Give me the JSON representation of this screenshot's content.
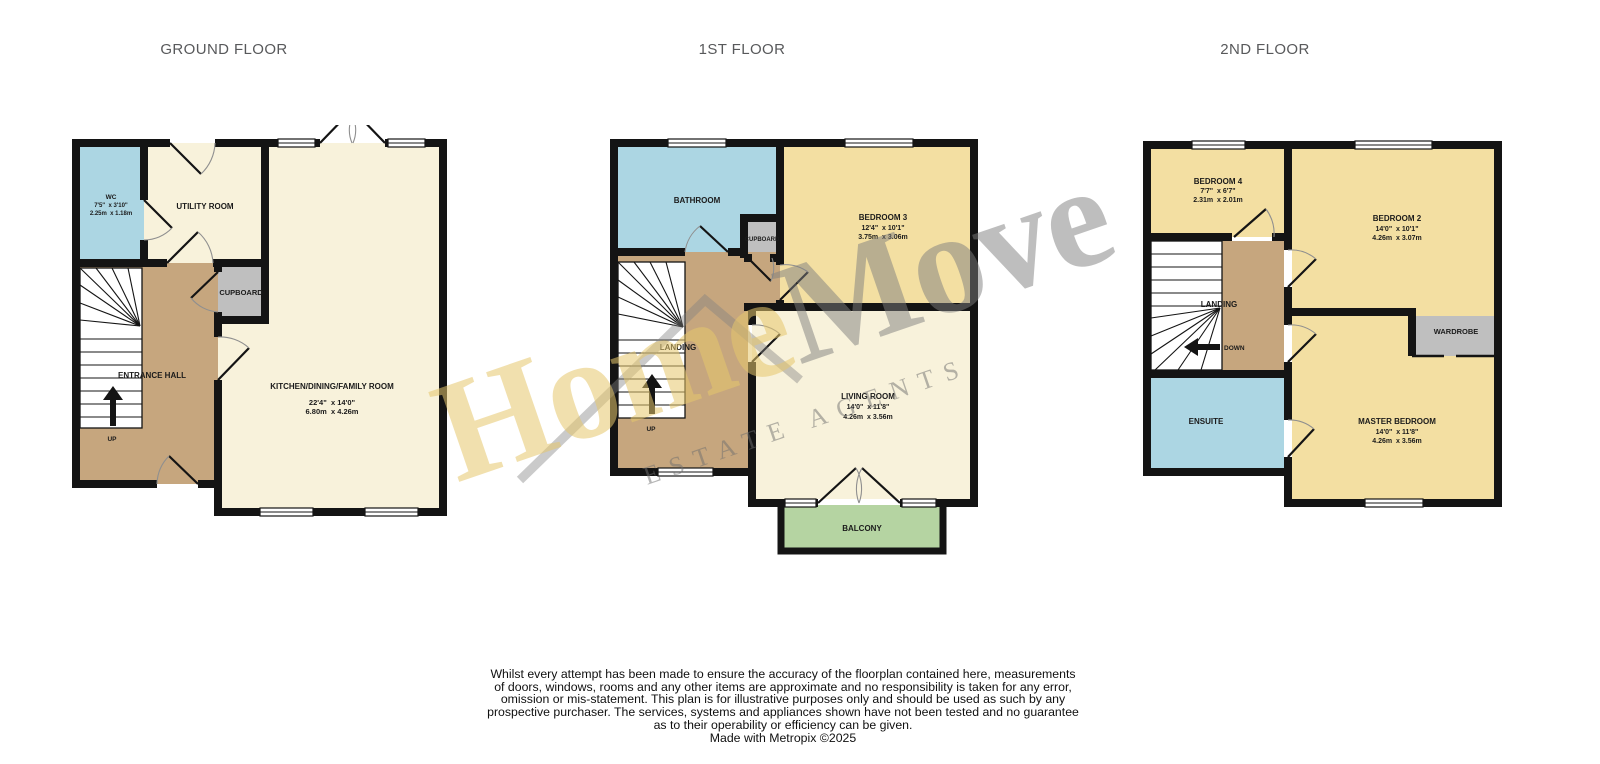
{
  "titles": {
    "ground": "GROUND FLOOR",
    "first": "1ST FLOOR",
    "second": "2ND FLOOR"
  },
  "ground_floor": {
    "wc_name": "WC",
    "wc_dims_imperial": "7'5\"  x 3'10\"",
    "wc_dims_metric": "2.25m  x 1.18m",
    "utility": "UTILITY ROOM",
    "cupboard": "CUPBOARD",
    "entrance_hall": "ENTRANCE HALL",
    "kitchen_name": "KITCHEN/DINING/FAMILY ROOM",
    "kitchen_dims_imperial": "22'4\"  x 14'0\"",
    "kitchen_dims_metric": "6.80m  x 4.26m",
    "stairs": "UP"
  },
  "first_floor": {
    "bathroom": "BATHROOM",
    "cupboard": "CUPBOARD",
    "bedroom3_name": "BEDROOM 3",
    "bedroom3_dims_imperial": "12'4\"  x 10'1\"",
    "bedroom3_dims_metric": "3.75m  x 3.06m",
    "landing": "LANDING",
    "stairs": "UP",
    "living_name": "LIVING ROOM",
    "living_dims_imperial": "14'0\"  x 11'8\"",
    "living_dims_metric": "4.26m  x 3.56m",
    "balcony": "BALCONY"
  },
  "second_floor": {
    "bedroom4_name": "BEDROOM 4",
    "bedroom4_dims_imperial": "7'7\"  x 6'7\"",
    "bedroom4_dims_metric": "2.31m  x 2.01m",
    "bedroom2_name": "BEDROOM 2",
    "bedroom2_dims_imperial": "14'0\"  x 10'1\"",
    "bedroom2_dims_metric": "4.26m  x 3.07m",
    "landing": "LANDING",
    "stairs": "DOWN",
    "wardrobe": "WARDROBE",
    "ensuite": "ENSUITE",
    "master_name": "MASTER BEDROOM",
    "master_dims_imperial": "14'0\"  x 11'8\"",
    "master_dims_metric": "4.26m  x 3.56m"
  },
  "watermark": {
    "word_primary": "Home",
    "word_secondary": "Move",
    "tagline": "ESTATE AGENTS",
    "primary_color": "#e6c76c",
    "secondary_color": "#7d7d7d"
  },
  "colors": {
    "room_cream": "#f8f2db",
    "room_yellow": "#f3dfa2",
    "room_blue": "#acd6e3",
    "room_green": "#b5d4a2",
    "room_brown": "#c6a67e",
    "room_gray": "#bfbfbf",
    "wall": "#141414"
  },
  "disclaimer": {
    "lines": [
      "Whilst every attempt has been made to ensure the accuracy of the floorplan contained here, measurements",
      "of doors, windows, rooms and any other items are approximate and no responsibility is taken for any error,",
      "omission or mis-statement. This plan is for illustrative purposes only and should be used as such by any",
      "prospective purchaser. The services, systems and appliances shown have not been tested and no guarantee",
      "as to their operability or efficiency can be given."
    ],
    "credit": "Made with Metropix ©2025"
  }
}
